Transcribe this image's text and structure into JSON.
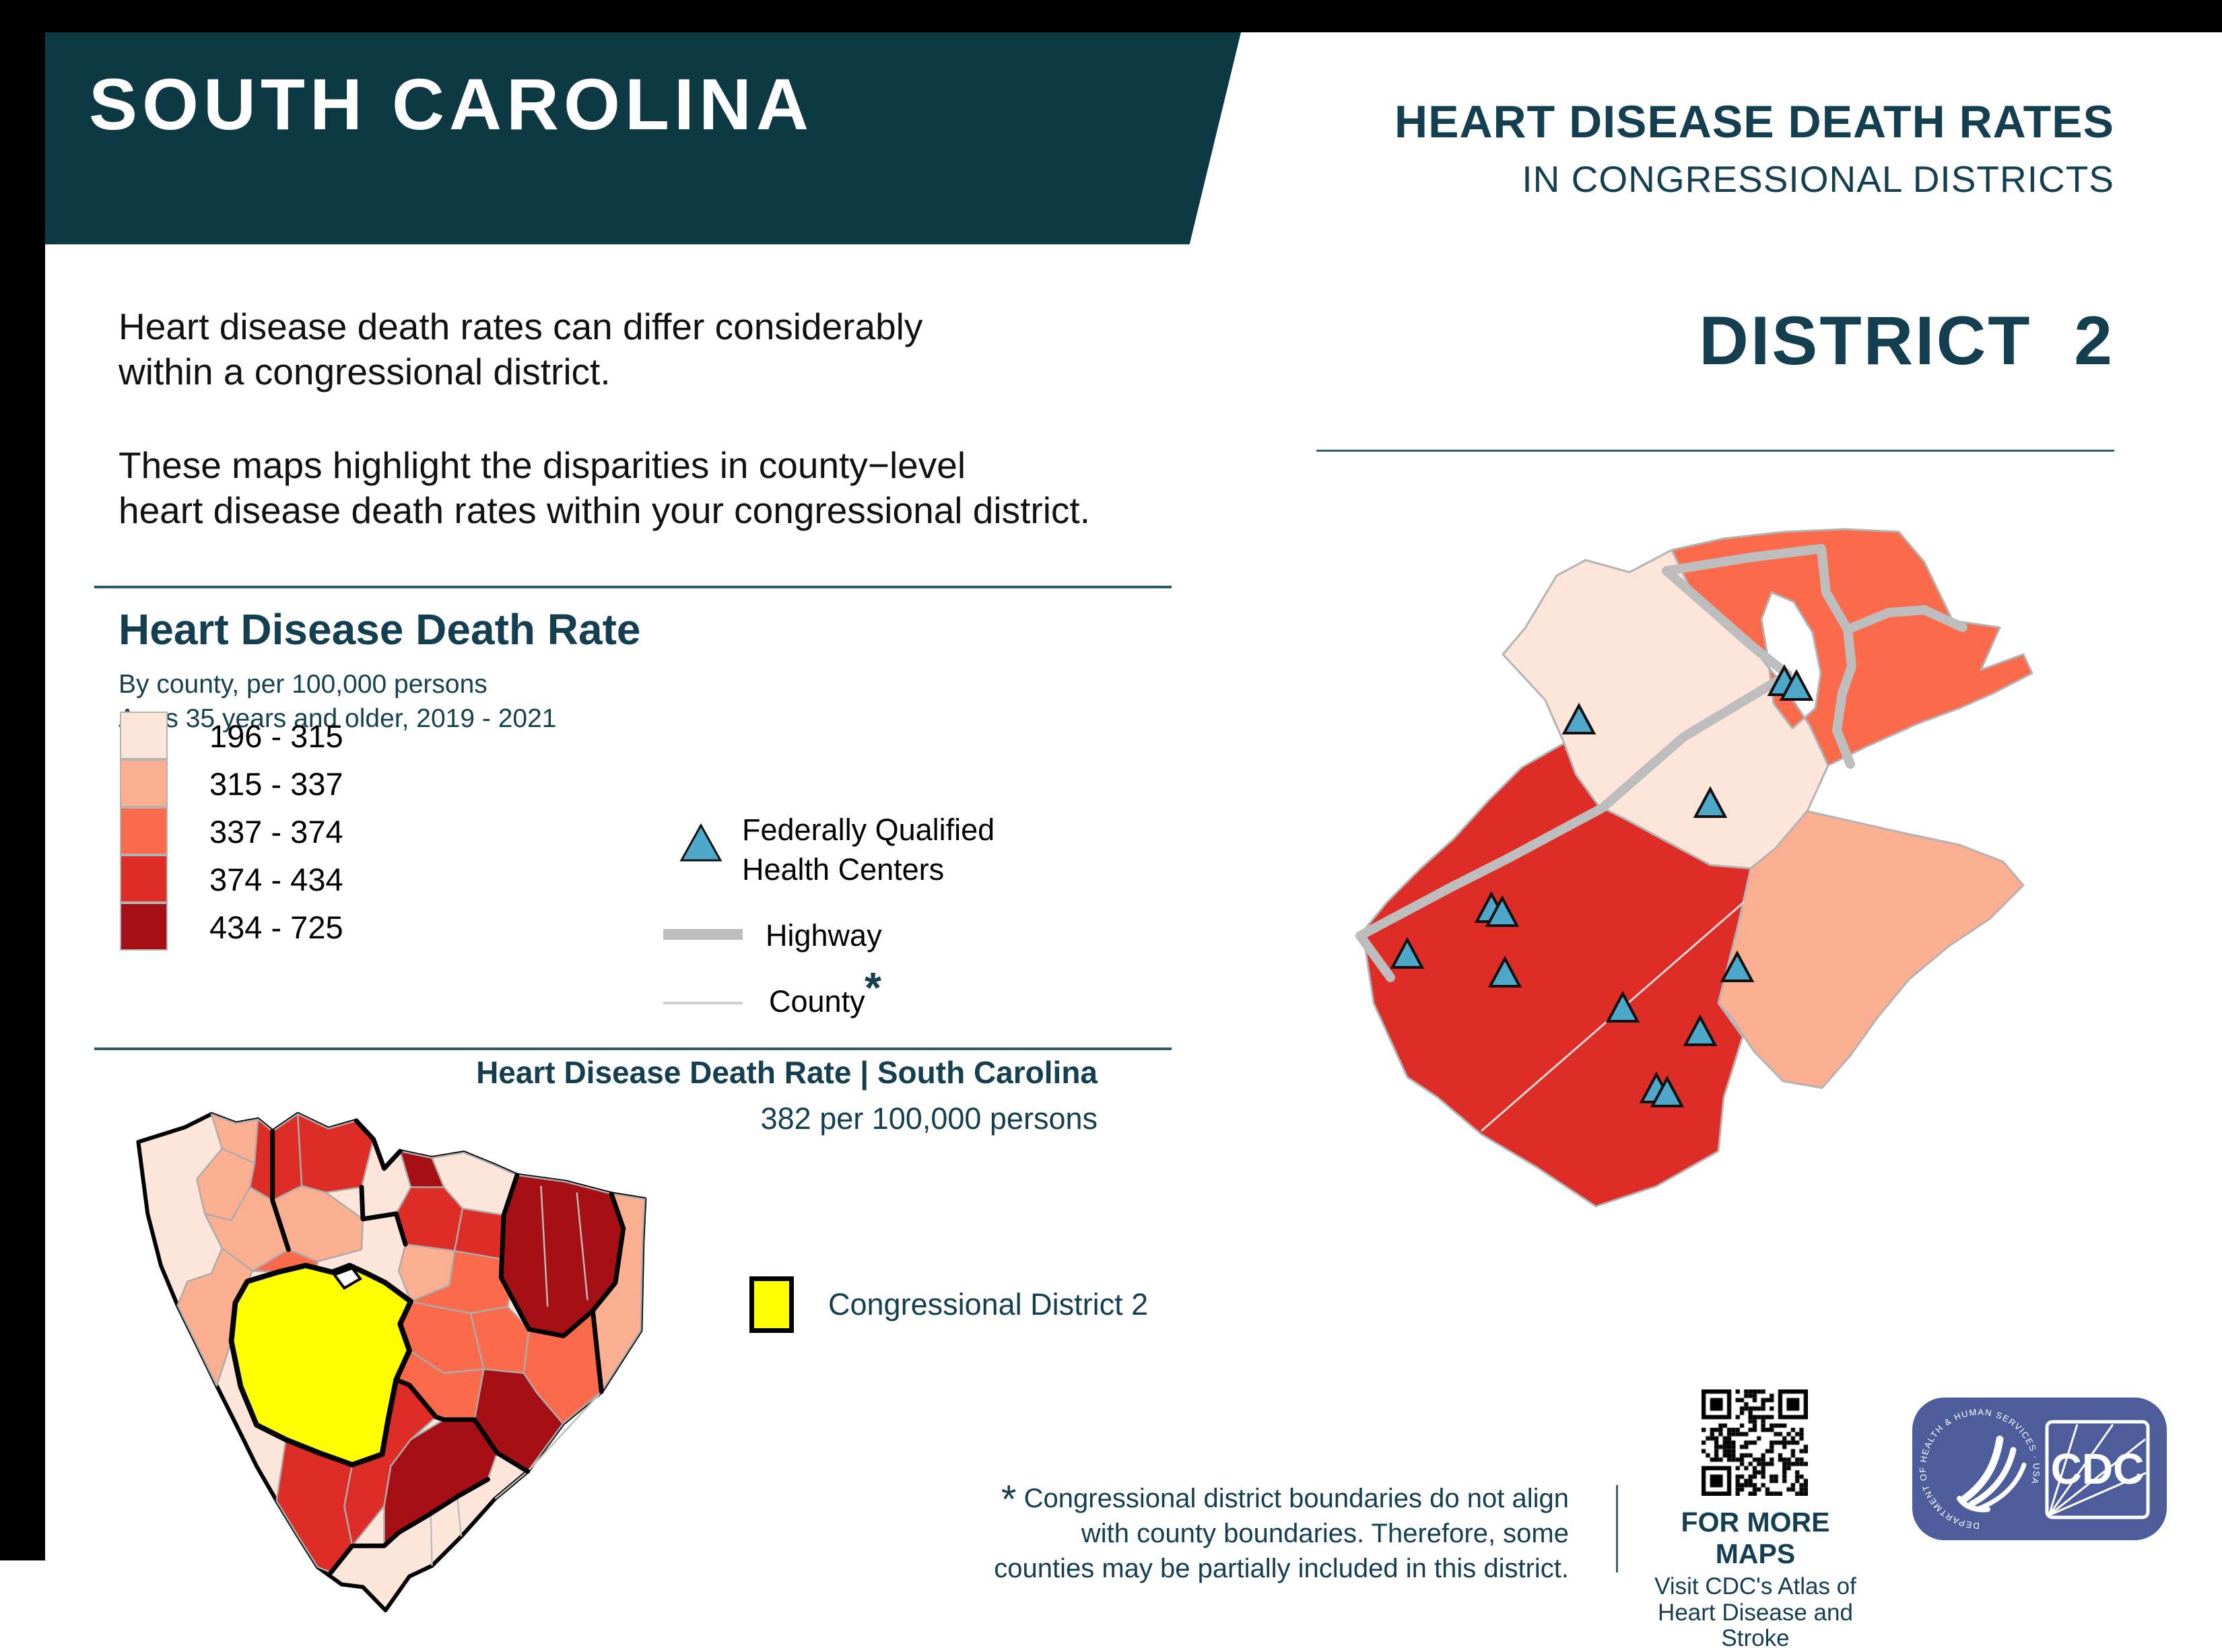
{
  "banner": {
    "title": "SOUTH CAROLINA"
  },
  "header": {
    "title": "HEART DISEASE DEATH RATES",
    "subtitle": "IN CONGRESSIONAL DISTRICTS",
    "district": "DISTRICT  2"
  },
  "intro": {
    "p1_line1": "Heart disease death rates can differ considerably",
    "p1_line2": "within a congressional district.",
    "p2_line1": "These maps highlight the disparities in county−level",
    "p2_line2": "heart disease death rates within your congressional district."
  },
  "legend": {
    "title": "Heart Disease Death Rate",
    "subtitle_line1": "By county, per 100,000 persons",
    "subtitle_line2": "Ages 35 years and older, 2019 - 2021",
    "classes": [
      {
        "range": "196 - 315",
        "color": "#FEE5D9"
      },
      {
        "range": "315 - 337",
        "color": "#FCAE91"
      },
      {
        "range": "337 - 374",
        "color": "#FB6A4A"
      },
      {
        "range": "374 - 434",
        "color": "#DE2D26"
      },
      {
        "range": "434 - 725",
        "color": "#A50F15"
      }
    ],
    "fqhc_line1": "Federally Qualified",
    "fqhc_line2": "Health Centers",
    "highway_label": "Highway",
    "county_label": "County",
    "county_asterisk": "*"
  },
  "state_map": {
    "title": "Heart Disease Death Rate | South Carolina",
    "subtitle": "382 per 100,000 persons",
    "district_legend_label": "Congressional District 2"
  },
  "footer": {
    "note_asterisk": "*",
    "note_line1": "Congressional district boundaries do not align",
    "note_line2": "with county boundaries. Therefore, some",
    "note_line3": "counties may be partially included in this district.",
    "more_maps_title": "FOR MORE MAPS",
    "more_maps_line1": "Visit CDC's Atlas of",
    "more_maps_line2": "Heart Disease and Stroke",
    "cdc_logo_text": "CDC",
    "hhs_circle_text": "DEPARTMENT OF HEALTH & HUMAN SERVICES · USA"
  },
  "colors": {
    "banner": "#0D3945",
    "teal": "#133F50",
    "c1": "#FEE5D9",
    "c2": "#FCAE91",
    "c3": "#FB6A4A",
    "c4": "#DE2D26",
    "c5": "#A50F15",
    "yellow": "#FFFF00",
    "highway": "#BDBDBD",
    "county_line": "#CFCFCF",
    "fqhc": "#4EA8C9",
    "cdc_blue": "#4D5C9B"
  }
}
